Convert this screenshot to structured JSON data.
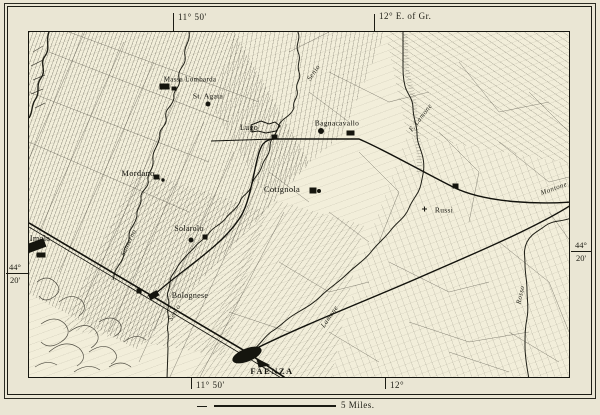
{
  "graticule": {
    "top_left_lon": "11° 50'",
    "top_right_lon": "12° E. of Gr.",
    "bottom_left_lon": "11° 50'",
    "bottom_right_lon": "12°",
    "left_lat_deg": "44°",
    "left_lat_min": "20'",
    "right_lat_deg": "44°",
    "right_lat_min": "20'"
  },
  "scale": {
    "label": "5 Miles."
  },
  "towns": [
    {
      "name": "Massa Lombarda"
    },
    {
      "name": "St. Agata"
    },
    {
      "name": "Lugo"
    },
    {
      "name": "Bagnacavallo"
    },
    {
      "name": "Mordano"
    },
    {
      "name": "Solarolo"
    },
    {
      "name": "Cotignola"
    },
    {
      "name": "Russi"
    },
    {
      "name": "Bolognese"
    },
    {
      "name": "FAENZA"
    },
    {
      "name": "Imola"
    }
  ],
  "rivers": [
    {
      "name": "Senio"
    },
    {
      "name": "F. Lamone"
    },
    {
      "name": "Santerno"
    },
    {
      "name": "Senio"
    },
    {
      "name": "Lamone"
    },
    {
      "name": "Montone"
    },
    {
      "name": "Rosso"
    }
  ],
  "colors": {
    "paper": "#eae6d4",
    "map_paper": "#f2eeda",
    "ink": "#1c1c14"
  }
}
